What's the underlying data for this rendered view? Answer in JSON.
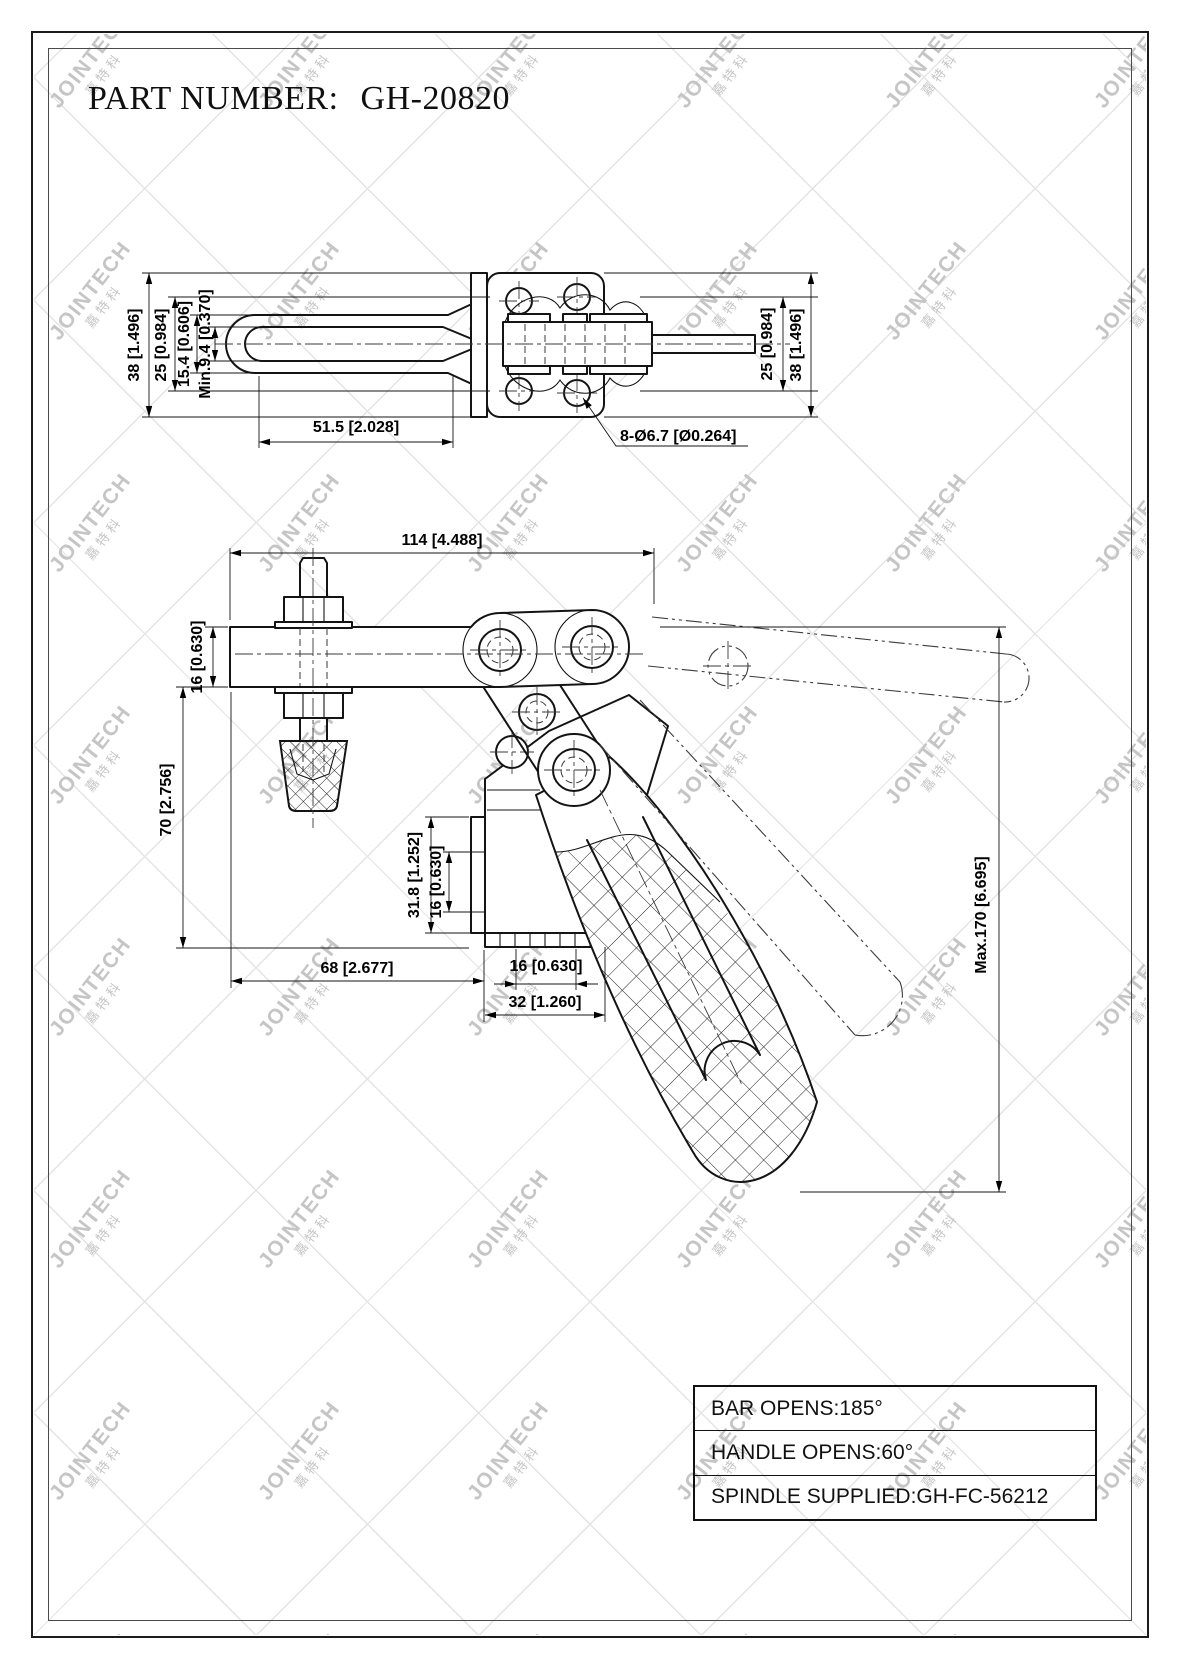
{
  "title": {
    "label": "PART NUMBER:",
    "value": "GH-20820"
  },
  "watermark": {
    "text": "JOINTECH",
    "cjk": "嘉特科"
  },
  "top_view": {
    "dim_38_left": "38 [1.496]",
    "dim_25_left": "25 [0.984]",
    "dim_154": "15.4 [0.606]",
    "dim_min94": "Min.9.4 [0.370]",
    "dim_515": "51.5 [2.028]",
    "dim_holes": "8-Ø6.7 [Ø0.264]",
    "dim_25_right": "25 [0.984]",
    "dim_38_right": "38 [1.496]"
  },
  "side_view": {
    "dim_114": "114 [4.488]",
    "dim_16_arm": "16 [0.630]",
    "dim_70": "70 [2.756]",
    "dim_318": "31.8 [1.252]",
    "dim_16_flange": "16 [0.630]",
    "dim_68": "68 [2.677]",
    "dim_16_foot": "16 [0.630]",
    "dim_32": "32 [1.260]",
    "dim_max170": "Max.170 [6.695]"
  },
  "spec_table": {
    "rows": [
      "BAR OPENS:185°",
      "HANDLE OPENS:60°",
      "SPINDLE SUPPLIED:GH-FC-56212"
    ]
  }
}
